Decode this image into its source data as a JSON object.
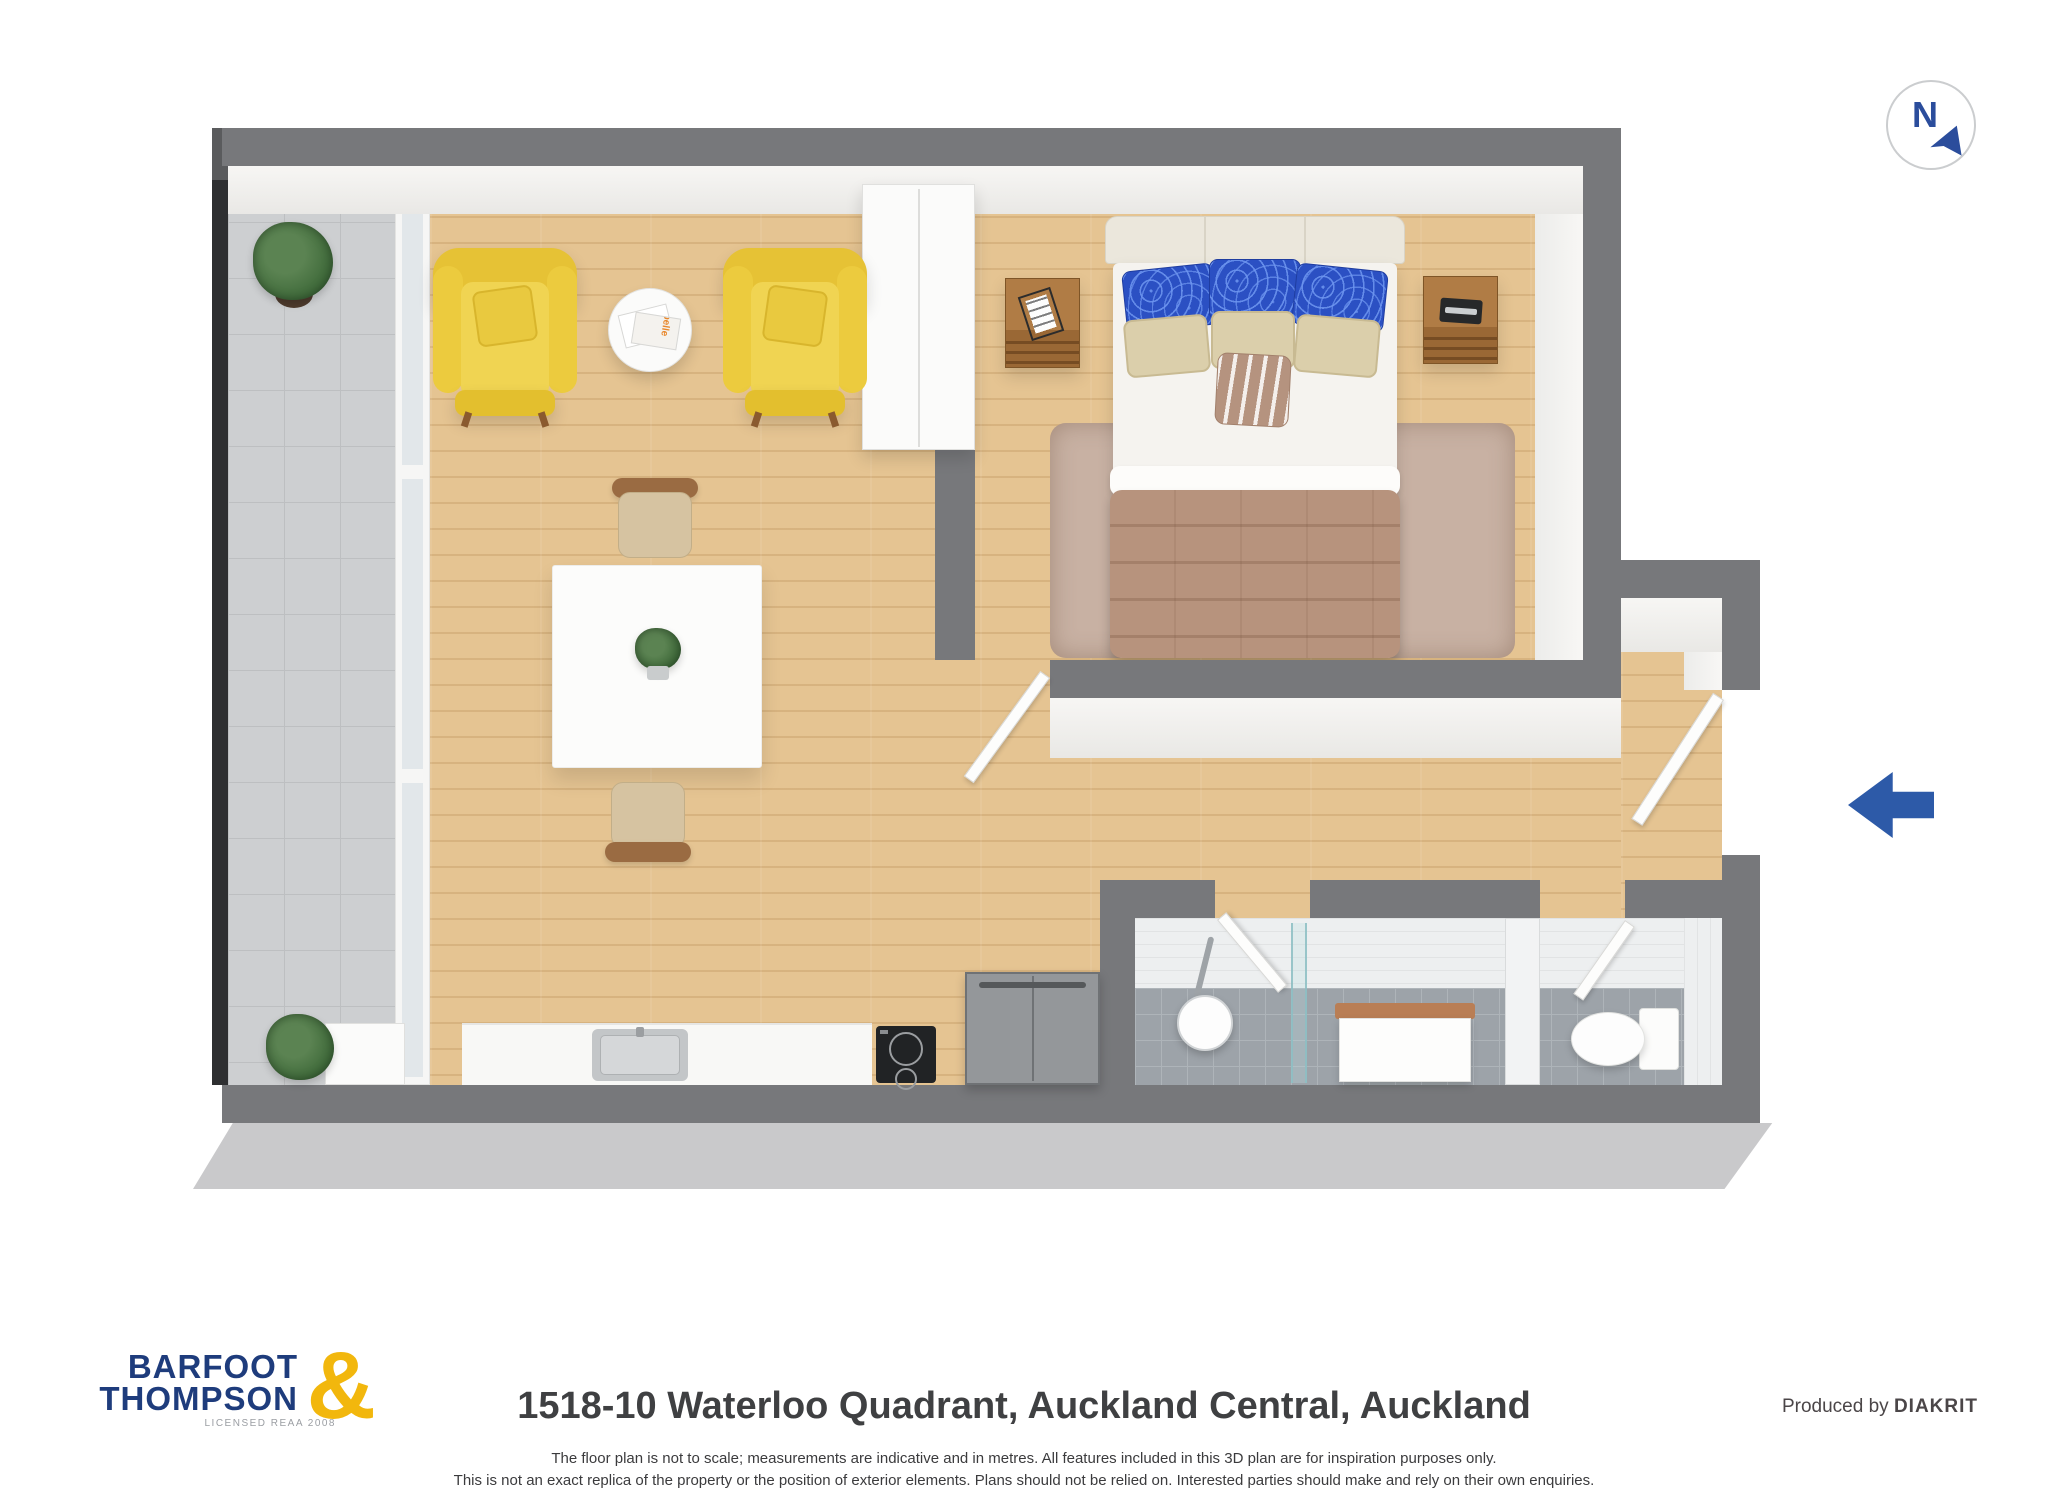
{
  "compass": {
    "letter": "N"
  },
  "living": {
    "magazine_label": "belle"
  },
  "footer": {
    "logo": {
      "line1": "BARFOOT",
      "line2": "THOMPSON",
      "ampersand": "&",
      "tagline": "LICENSED REAA 2008"
    },
    "title": "1518-10 Waterloo Quadrant, Auckland Central, Auckland",
    "disclaimer_line1": "The floor plan is not to scale; measurements are indicative and in metres. All features included in this 3D plan are for inspiration purposes only.",
    "disclaimer_line2": "This is not an exact replica of the property or the position of exterior elements. Plans should not be relied on. Interested parties should make and rely on their own enquiries.",
    "produced_by_prefix": "Produced by",
    "producer": "DIAKRIT"
  },
  "palette": {
    "wall_gray": "#77787b",
    "wall_face_white": "#f4f3f1",
    "wood_floor": "#e5c492",
    "balcony_tile": "#cdcfd1",
    "bathroom_tile": "#9da3a9",
    "armchair_yellow": "#eccb3e",
    "pillow_blue": "#2b50c3",
    "pillow_beige": "#dbcfab",
    "comforter_taupe": "#b7937d",
    "rug_taupe": "#c8b1a3",
    "nightstand_wood": "#ab7843",
    "entry_arrow_blue": "#2d5aa8",
    "compass_blue": "#2b4d9c",
    "logo_navy": "#1e3c7c",
    "logo_yellow": "#f2b70d"
  }
}
